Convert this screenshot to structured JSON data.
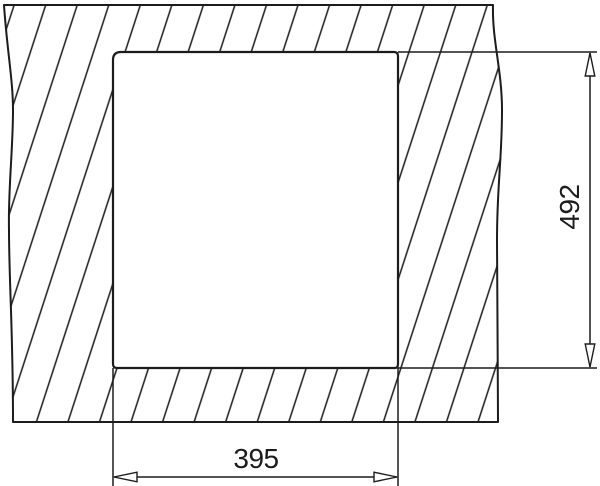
{
  "drawing": {
    "type": "technical-installation-diagram",
    "subject": "sink-cutout-top-view",
    "background_color": "#ffffff",
    "line_color": "#1c1c1c",
    "dimensions": {
      "height": {
        "label": "492",
        "orientation": "vertical",
        "position": "right"
      },
      "width": {
        "label": "395",
        "orientation": "horizontal",
        "position": "bottom"
      }
    }
  }
}
